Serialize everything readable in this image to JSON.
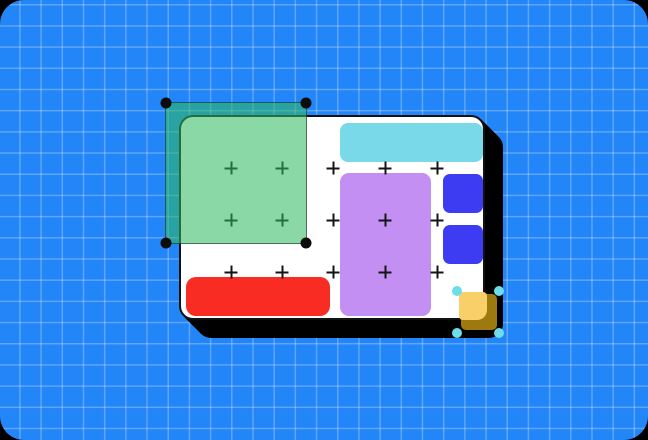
{
  "colors": {
    "bg": "#2285f8",
    "grid": "rgba(255,255,255,0.27)",
    "card": "#ffffff",
    "card-border": "#121212",
    "shadow": "#000000",
    "cyan": "#79d9e8",
    "purple": "#c48ff2",
    "indigo": "#3d3cf2",
    "red": "#f92c24",
    "green-fill": "rgba(47,186,97,0.56)",
    "green-border": "rgba(22,28,23,0.55)",
    "handle-black": "#0c0c0c",
    "gold-dark": "#9c7a10",
    "gold-light": "#f8cf68",
    "handle-cyan": "#6edce9",
    "plus": "#141414"
  },
  "plus_markers": {
    "columns": [
      231,
      282,
      333,
      385,
      437
    ],
    "rows": [
      168,
      220,
      272
    ]
  },
  "objects": {
    "artboard": {
      "type": "frame",
      "fill_key": "card"
    },
    "shapes": [
      {
        "name": "cyan-banner-shape",
        "type": "rounded-rect",
        "color_key": "cyan"
      },
      {
        "name": "purple-panel-shape",
        "type": "rounded-rect",
        "color_key": "purple"
      },
      {
        "name": "indigo-square-shape-1",
        "type": "rounded-rect",
        "color_key": "indigo"
      },
      {
        "name": "indigo-square-shape-2",
        "type": "rounded-rect",
        "color_key": "indigo"
      },
      {
        "name": "red-bar-shape",
        "type": "rounded-rect",
        "color_key": "red"
      }
    ],
    "selection_overlay": {
      "type": "marquee-selection",
      "corner_handles": 4,
      "handle_color_key": "handle-black"
    },
    "gold_component": {
      "type": "layered-square",
      "corner_handles": 4,
      "handle_color_key": "handle-cyan"
    }
  }
}
